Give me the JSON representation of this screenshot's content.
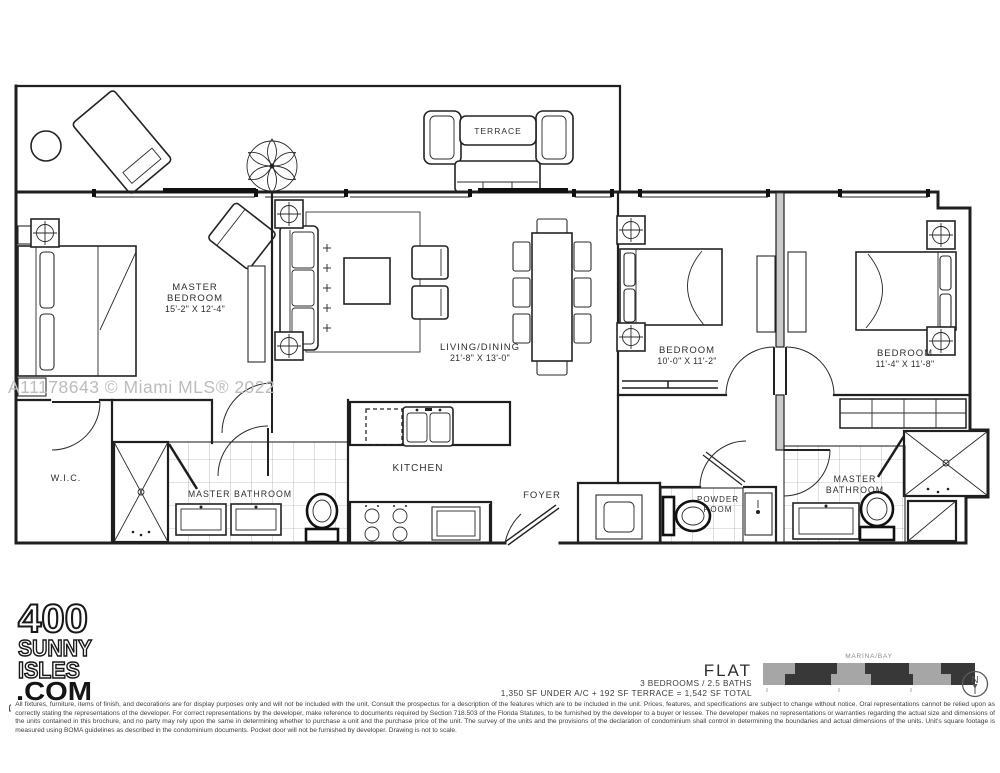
{
  "watermark": "A11178643 © Miami MLS® 2022",
  "plan": {
    "terrace_label": "TERRACE",
    "rooms": {
      "master_bedroom": {
        "line1": "MASTER",
        "line2": "BEDROOM",
        "dims": "15'-2\" X 12'-4\""
      },
      "living_dining": {
        "line1": "LIVING/DINING",
        "dims": "21'-8\" X 13'-0\""
      },
      "bedroom_2": {
        "line1": "BEDROOM",
        "dims": "10'-0\" X 11'-2\""
      },
      "bedroom_3": {
        "line1": "BEDROOM",
        "dims": "11'-4\" X 11'-8\""
      },
      "wic": {
        "line1": "W.I.C."
      },
      "master_bathroom_left": {
        "line1": "MASTER BATHROOM"
      },
      "kitchen": {
        "line1": "KITCHEN"
      },
      "foyer": {
        "line1": "FOYER"
      },
      "powder_room": {
        "line1": "POWDER",
        "line2": "ROOM"
      },
      "master_bathroom_right": {
        "line1": "MASTER",
        "line2": "BATHROOM"
      }
    }
  },
  "branding": {
    "logo": [
      "400",
      "SUNNY",
      "ISLES",
      ".COM"
    ]
  },
  "unit_info": {
    "title": "FLAT",
    "specs": "3 BEDROOMS / 2.5 BATHS",
    "area": "1,350 SF UNDER A/C + 192 SF TERRACE = 1,542 SF TOTAL"
  },
  "key_plan": {
    "location": "MARINA/BAY",
    "north": "N"
  },
  "disclaimer": "All fixtures, furniture, items of finish, and decorations are for display purposes only and will not be included with the unit.  Consult the prospectus for a description of the features which are to be included in the unit.  Prices, features, and specifications are subject to change without notice.  Oral representations cannot be relied upon as correctly stating the representations of the developer.  For correct representations by the developer, make reference to documents required by Section 718.503 of the Florida Statutes, to be furnished by the developer to a buyer or lessee.  The developer makes no representations or warranties regarding the actual size and dimensions of the units contained in this brochure, and no party may rely upon the same in determining whether to purchase a unit and the purchase price of the unit. The survey of the units and the provisions of the declaration of condominium shall control in determining the boundaries and actual dimensions of the units.  Unit's square footage is measured using BOMA guidelines as described in the condominium documents.  Pocket door will not be furnished by developer.  Drawing is not to scale.",
  "colors": {
    "line": "#1f1f1f",
    "watermark": "#bcbcbc",
    "keyplan_gray": "#a6a6a6",
    "keyplan_dark": "#383838"
  }
}
